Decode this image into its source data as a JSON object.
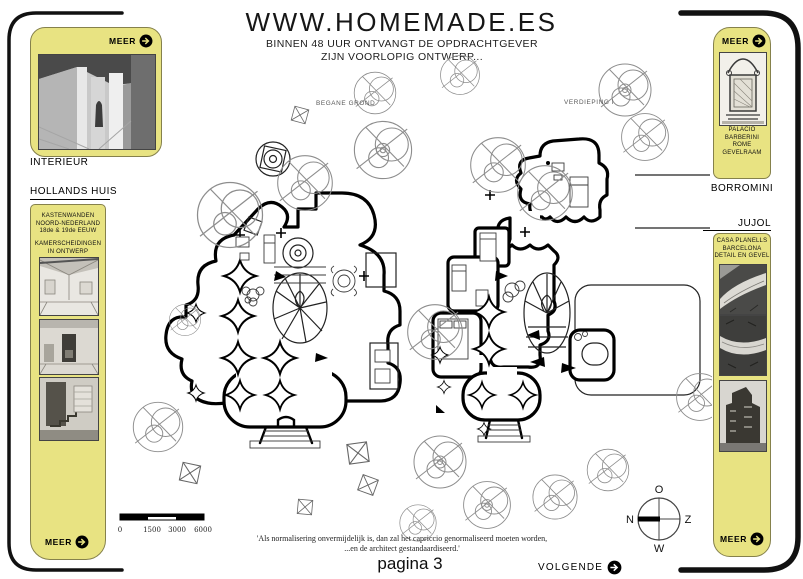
{
  "header": {
    "site_title": "WWW.HOMEMADE.ES",
    "subtitle_line1": "BINNEN 48 UUR ONTVANGT DE OPDRACHTGEVER",
    "subtitle_line2": "ZIJN VOORLOPIG ONTWERP..."
  },
  "left_sidebar": {
    "interieur": {
      "meer_label": "MEER",
      "caption": "INTERIEUR"
    },
    "hollands_huis": {
      "header": "HOLLANDS HUIS",
      "line1": "KASTENWANDEN",
      "line2": "NOORD-NEDERLAND",
      "line3": "18de & 19de EEUW",
      "line4": "KAMERSCHEIDINGEN",
      "line5": "IN ONTWERP",
      "meer_label": "MEER"
    }
  },
  "right_sidebar": {
    "borromini": {
      "meer_label": "MEER",
      "line1": "PALACIO BARBERINI",
      "line2": "ROME",
      "line3": "GEVELRAAM",
      "title": "BORROMINI"
    },
    "jujol": {
      "title": "JUJOL",
      "line1": "CASA PLANELLS",
      "line2": "BARCELONA",
      "line3": "DETAIL EN GEVEL",
      "meer_label": "MEER"
    }
  },
  "plans": {
    "ground_floor_label": "BEGANE GROND",
    "first_floor_label": "VERDIEPING I"
  },
  "scale_bar": {
    "tick0": "0",
    "tick1": "1500",
    "tick2": "3000",
    "tick3": "6000"
  },
  "compass": {
    "top": "O",
    "left": "N",
    "right": "Z",
    "bottom": "W"
  },
  "footer": {
    "quote_line1": "'Als normalisering onvermijdelijk is, dan zal het capriccio genormaliseerd moeten worden,",
    "quote_line2": "...en de architect gestandaardiseerd.'",
    "page_label": "pagina 3",
    "next_label": "VOLGENDE"
  },
  "colors": {
    "panel_yellow": "#e8e382",
    "ink": "#000000",
    "tree_gray": "#8d8d8d"
  }
}
